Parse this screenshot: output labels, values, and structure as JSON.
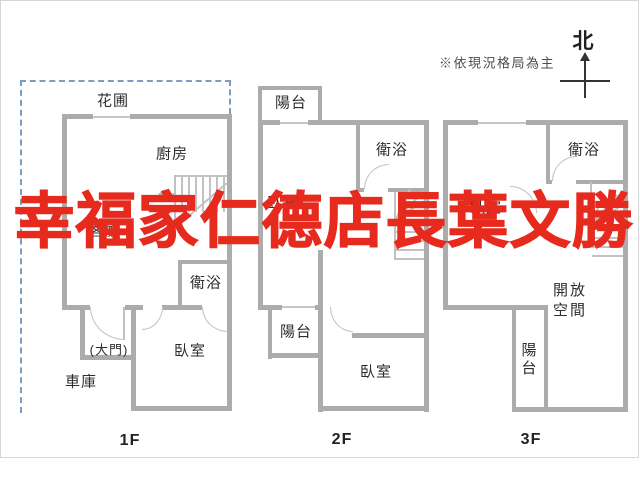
{
  "meta": {
    "north_label": "北",
    "note": "※依現況格局為主",
    "watermark": "幸福家仁德店長葉文勝"
  },
  "colors": {
    "wall": "#acacac",
    "thin_line": "#c6c6c6",
    "label_text": "#2e2e2e",
    "watermark_red": "#e62a1d",
    "dashed_border_blue": "#7e9cbb",
    "frame_border": "#d6d6d6"
  },
  "floors": {
    "f1": {
      "floor_label": "1F",
      "garden": "花圃",
      "kitchen": "廚房",
      "living": "客廳",
      "bath": "衛浴",
      "entry": "(大門)",
      "bedroom": "臥室",
      "garage": "車庫"
    },
    "f2": {
      "floor_label": "2F",
      "balcony_top": "陽台",
      "bath": "衛浴",
      "master_bedroom": "臥室",
      "balcony_mid": "陽台",
      "bedroom": "臥室"
    },
    "f3": {
      "floor_label": "3F",
      "bath": "衛浴",
      "bedroom": "臥室",
      "open_space": "開放空間",
      "balcony": "陽台"
    }
  }
}
